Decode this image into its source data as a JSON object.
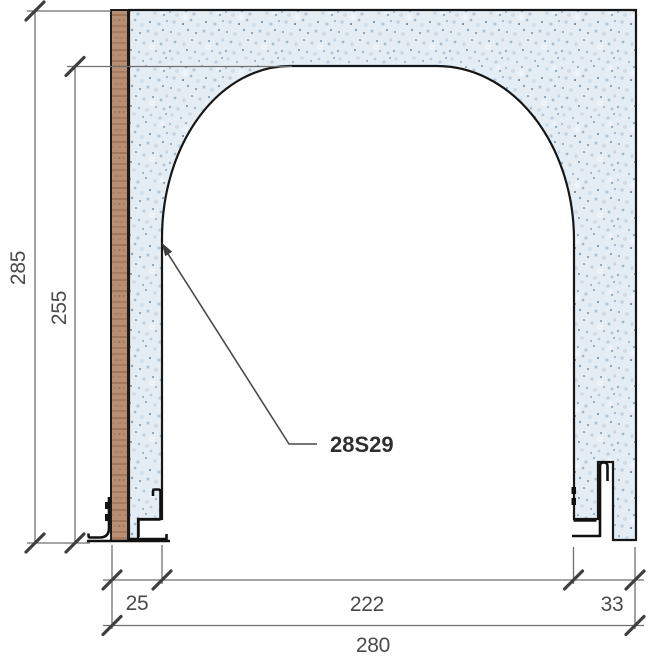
{
  "drawing": {
    "part_label": "28S29",
    "dims": {
      "height_total": "285",
      "height_opening": "255",
      "left_jamb": "25",
      "opening_width": "222",
      "right_jamb": "33",
      "total_width": "280"
    },
    "colors": {
      "concrete_base": "#e4edf4",
      "concrete_speckle_dark": "#2e5270",
      "wood_base": "#b98e71",
      "wood_grain": "#8a5d44",
      "outline": "#161616",
      "steel_profile": "#111111",
      "dimension_line": "#6f6f6f",
      "dimension_tick": "#3f3f3f",
      "dimension_text": "#4a4a4a"
    }
  }
}
